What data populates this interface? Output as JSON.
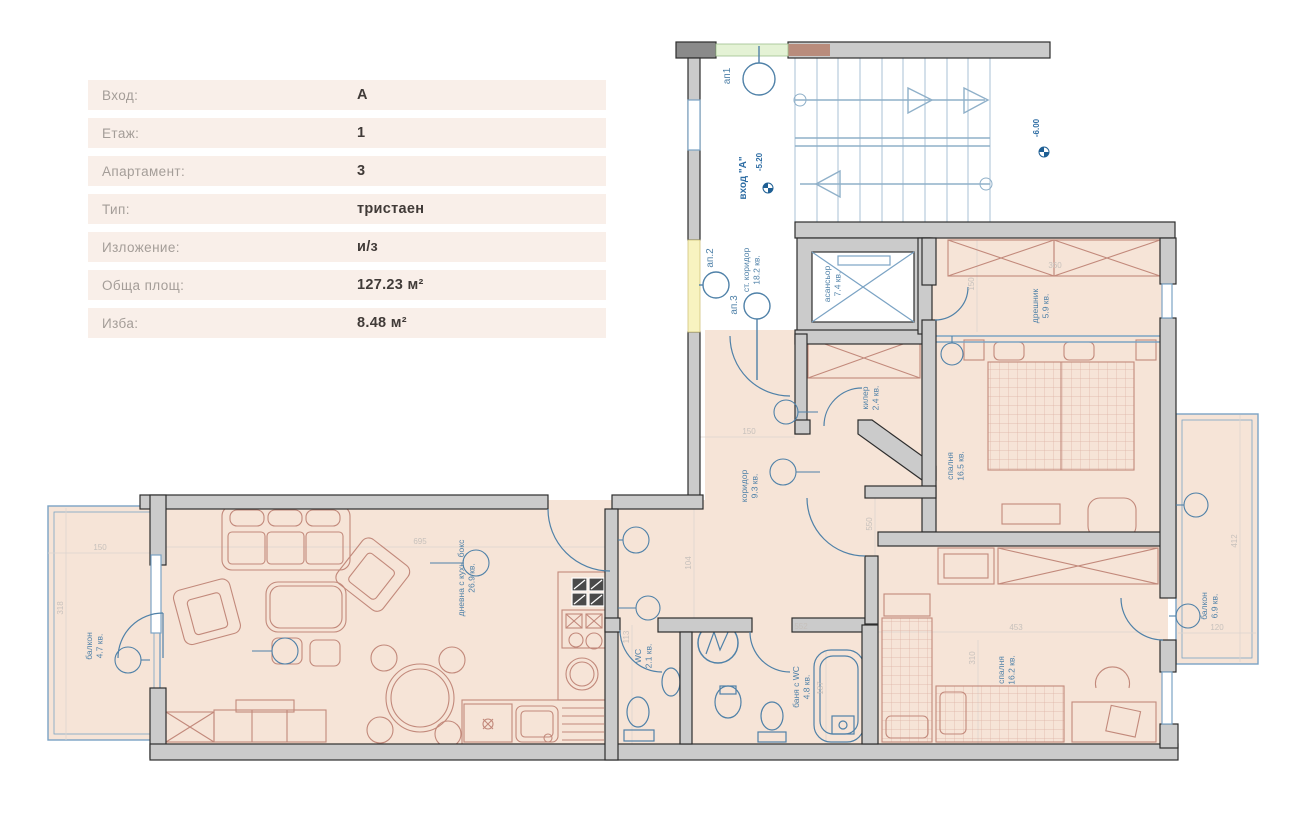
{
  "info_table": {
    "rows": [
      {
        "label": "Вход:",
        "value": "А"
      },
      {
        "label": "Етаж:",
        "value": "1"
      },
      {
        "label": "Апартамент:",
        "value": "3"
      },
      {
        "label": "Тип:",
        "value": "тристаен"
      },
      {
        "label": "Изложение:",
        "value": "и/з"
      },
      {
        "label": "Обща площ:",
        "value": "127.23 м²"
      },
      {
        "label": "Изба:",
        "value": "8.48 м²"
      }
    ]
  },
  "plan": {
    "unit_labels": {
      "ap1": "ап1",
      "ap2": "ап.2",
      "ap3": "ап.3"
    },
    "entrance": "вход \"А\"",
    "levels": {
      "stair": "-5.20",
      "right": "-6.00"
    },
    "rooms": {
      "living": {
        "name": "дневна с кухн. бокс",
        "area": "26.9 кв."
      },
      "balcony_left": {
        "name": "балкон",
        "area": "4.7 кв."
      },
      "corridor": {
        "name": "коридор",
        "area": "9.3 кв."
      },
      "wc": {
        "name": "WC",
        "area": "2.1 кв."
      },
      "bath": {
        "name": "баня с WC",
        "area": "4.8 кв."
      },
      "closet": {
        "name": "килер",
        "area": "2.4 кв."
      },
      "elevator": {
        "name": "асансьор",
        "area": "7.4 кв."
      },
      "stair_corridor": {
        "name": "ст. коридор",
        "area": "18.2 кв."
      },
      "bedroom1": {
        "name": "спалня",
        "area": "16.5 кв."
      },
      "dressing": {
        "name": "дрешник",
        "area": "5.9 кв."
      },
      "bedroom2": {
        "name": "спалня",
        "area": "16.2 кв."
      },
      "balcony_right": {
        "name": "балкон",
        "area": "6.9 кв."
      }
    },
    "dimensions": {
      "d695": "695",
      "d104": "104",
      "d113": "113",
      "d150a": "150",
      "d550": "550",
      "d360": "360",
      "d150b": "150",
      "d453": "453",
      "d310": "310",
      "d412": "412",
      "d120": "120",
      "d150c": "150",
      "d318": "318",
      "d552": "552",
      "d187": "187"
    },
    "colors": {
      "floor": "#f6e4d7",
      "wall": "#cbcbcb",
      "wall_edge": "#2d2d2d",
      "blue": "#4f81a8",
      "stair_blue": "#9db8cf",
      "furniture_red": "#c2897b",
      "door_green": "#e4f2d5",
      "door_yellow": "#f8f3c0",
      "table_row_bg": "#f9efe9"
    }
  }
}
